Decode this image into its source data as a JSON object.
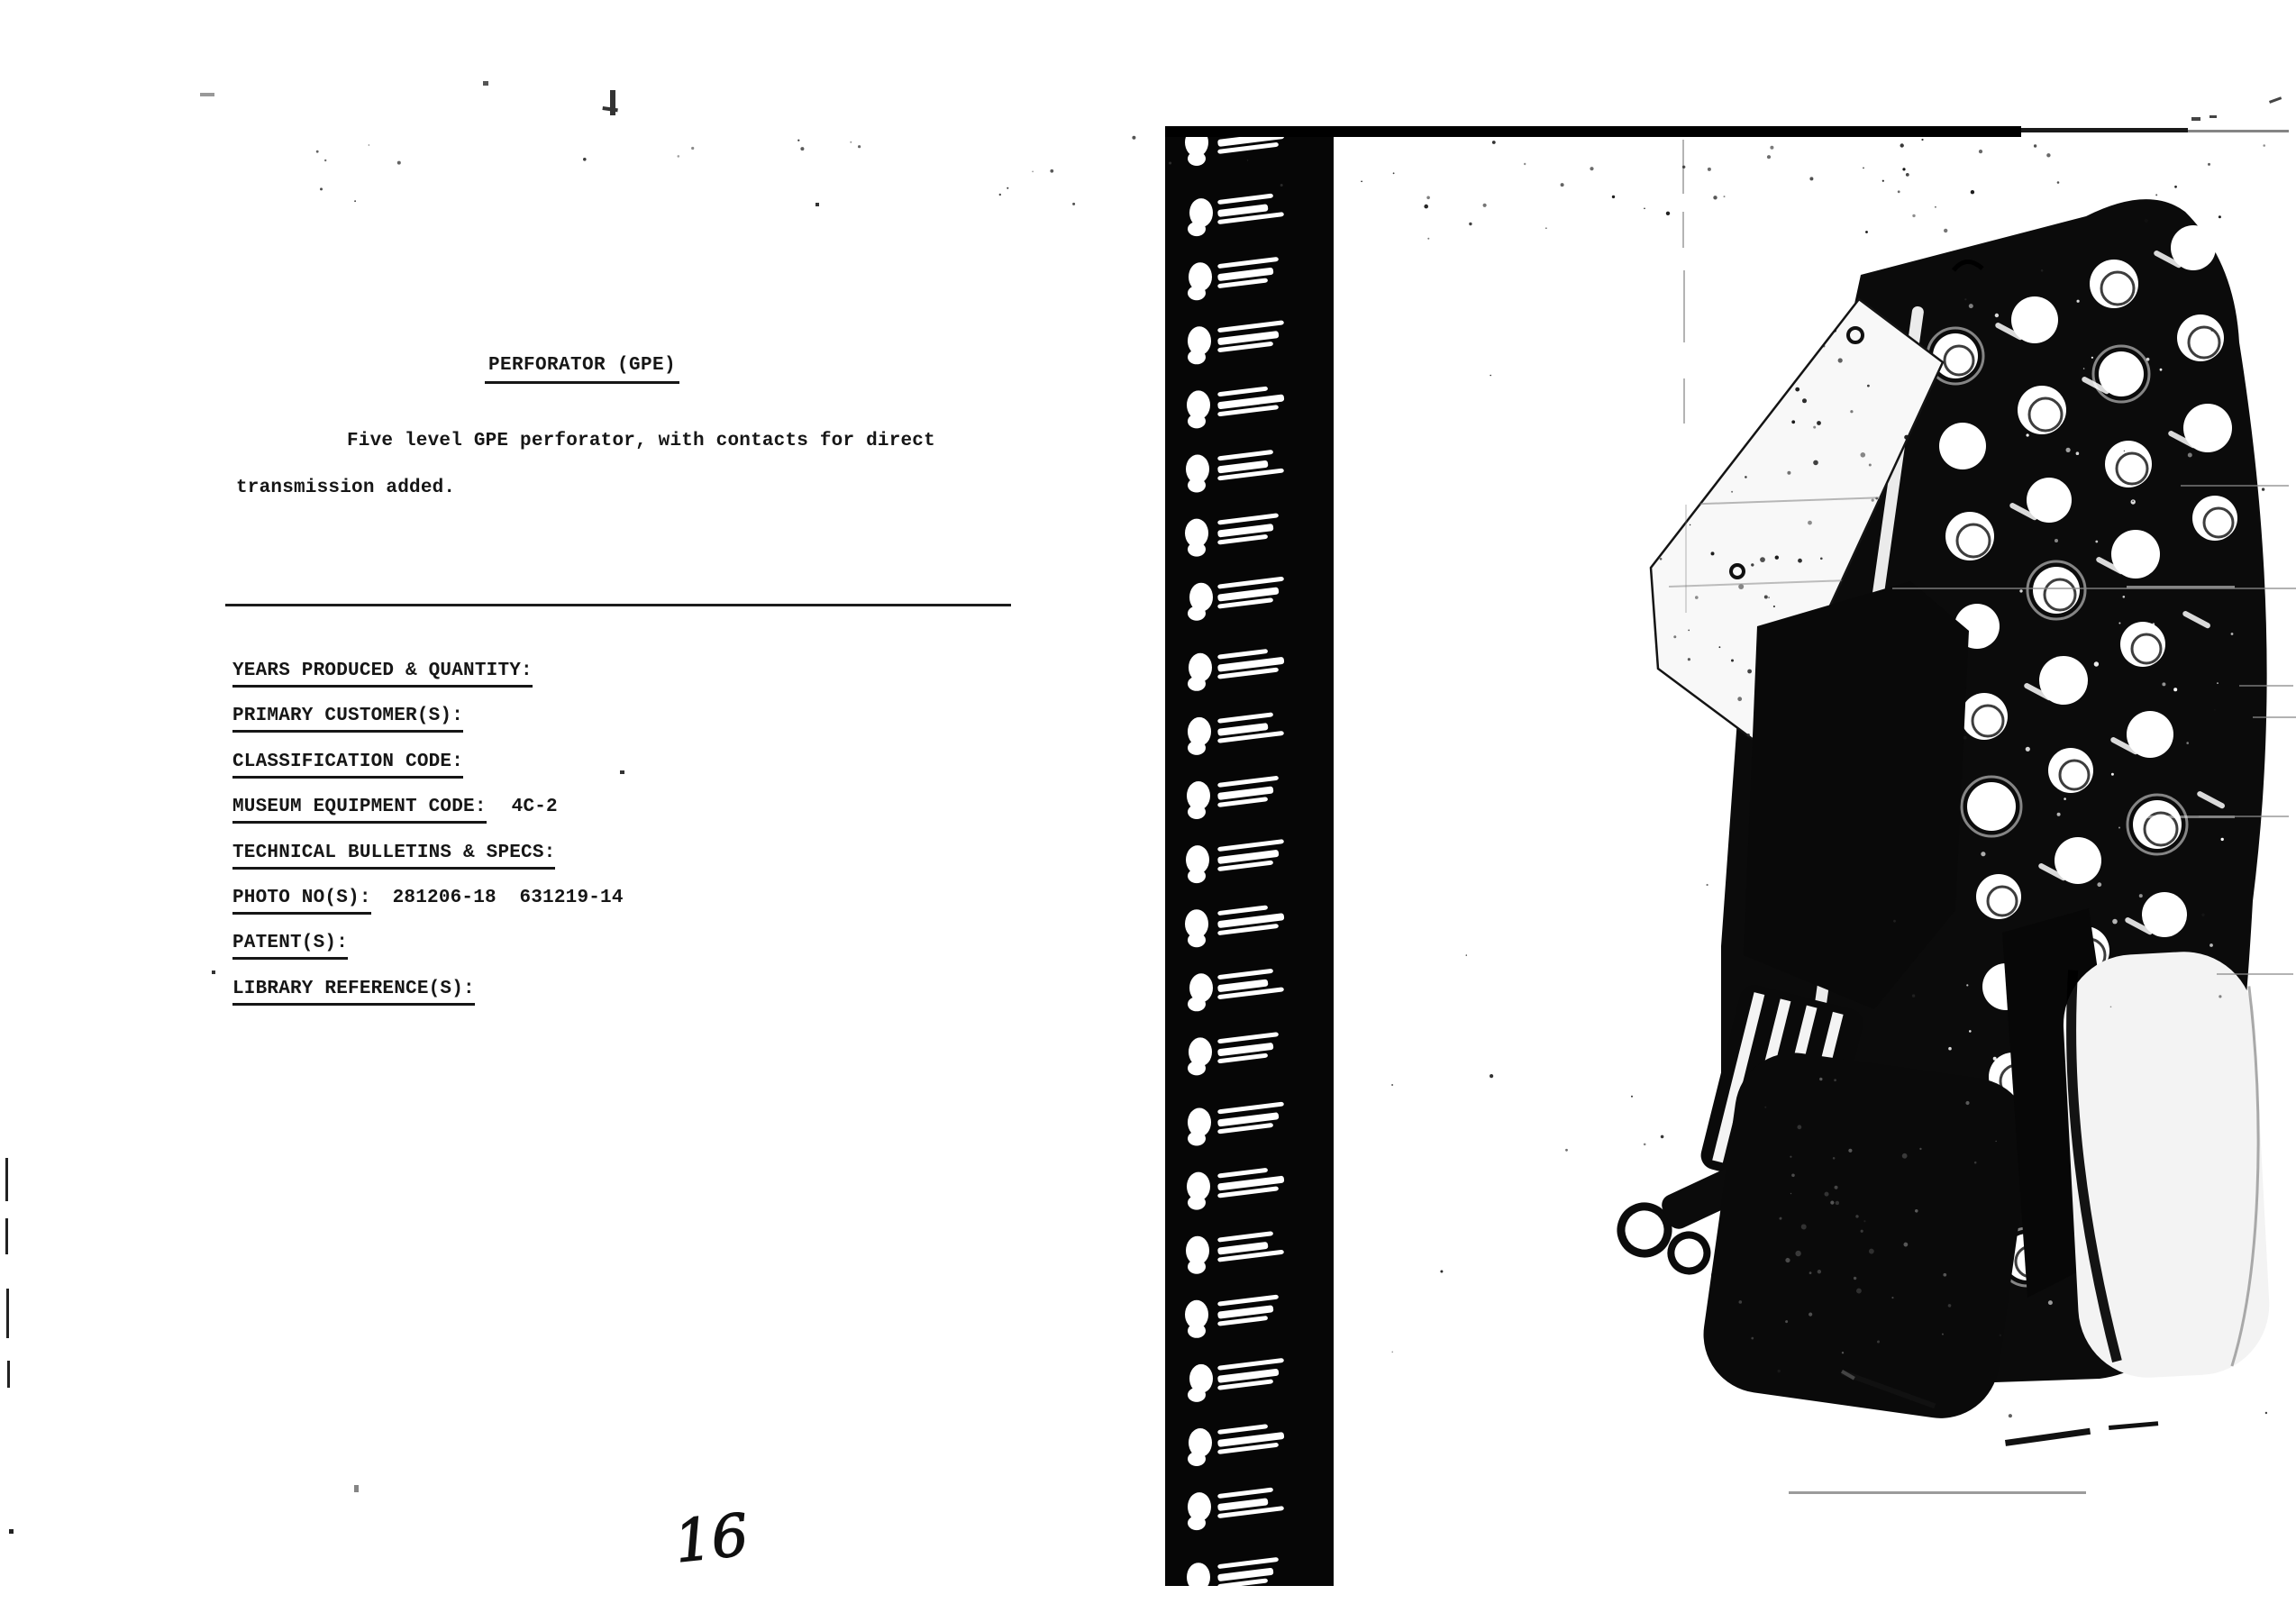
{
  "document": {
    "title": "PERFORATOR (GPE)",
    "description": "Five level GPE perforator, with contacts for direct transmission added.",
    "fields": [
      {
        "label": "YEARS PRODUCED & QUANTITY:",
        "value": ""
      },
      {
        "label": "PRIMARY CUSTOMER(S):",
        "value": ""
      },
      {
        "label": "CLASSIFICATION CODE:",
        "value": ""
      },
      {
        "label": "MUSEUM EQUIPMENT CODE:",
        "value": "4C-2"
      },
      {
        "label": "TECHNICAL BULLETINS & SPECS:",
        "value": ""
      },
      {
        "label": "PHOTO NO(S):",
        "value": "281206-18  631219-14"
      },
      {
        "label": "PATENT(S):",
        "value": ""
      },
      {
        "label": "LIBRARY REFERENCE(S):",
        "value": ""
      }
    ],
    "page_number": "16"
  },
  "colors": {
    "paper": "#ffffff",
    "ink": "#161616",
    "photo_black": "#0a0a0a"
  }
}
